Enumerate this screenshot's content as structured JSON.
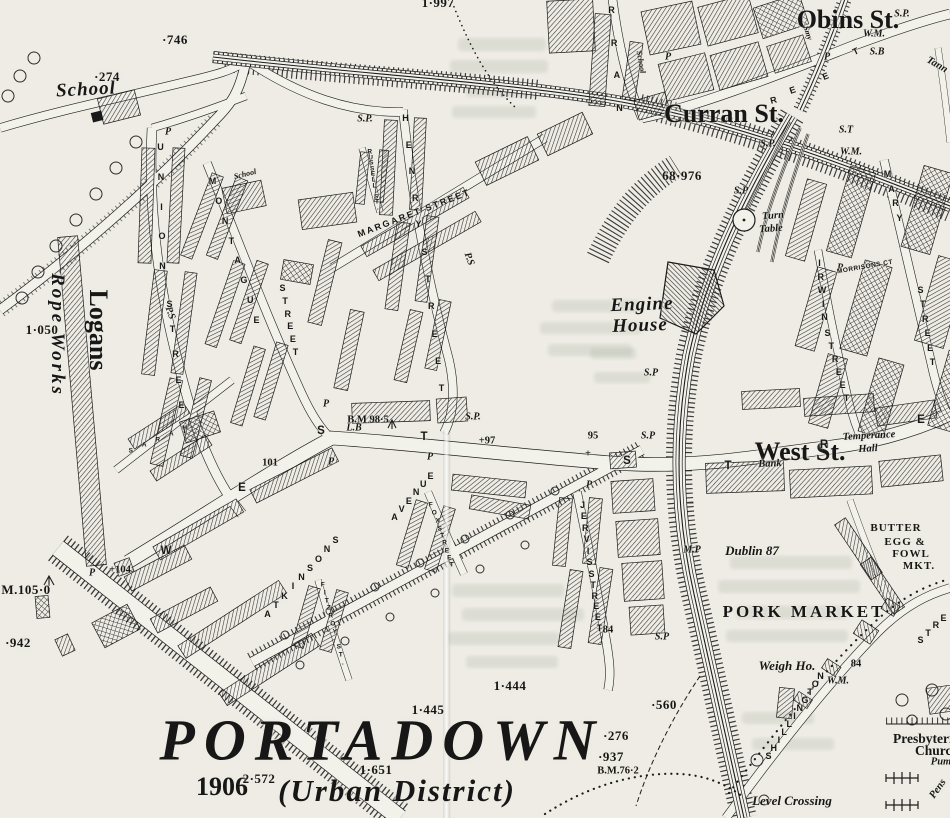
{
  "map": {
    "name": "Ordnance Survey town map, Portadown",
    "colors": {
      "paper": "#eeece4",
      "ink": "#171717",
      "annotation_red": "#cf2318"
    }
  },
  "labels": [
    {
      "t": "PORTADOWN",
      "x": 382,
      "y": 740,
      "c": "title",
      "n": "map-title"
    },
    {
      "t": "(Urban District)",
      "x": 397,
      "y": 791,
      "c": "subtitle",
      "n": "map-subtitle"
    },
    {
      "t": "1906",
      "x": 222,
      "y": 787,
      "c": "red",
      "n": "annotation-year"
    },
    {
      "t": "Obins St.",
      "x": 848,
      "y": 20,
      "c": "red",
      "n": "annotation-obins-st"
    },
    {
      "t": "Curran St.",
      "x": 724,
      "y": 114,
      "c": "red",
      "n": "annotation-curran-st"
    },
    {
      "t": "West St.",
      "x": 800,
      "y": 452,
      "c": "red",
      "n": "annotation-west-st"
    },
    {
      "t": "Logans",
      "x": 98,
      "y": 330,
      "r": 90,
      "c": "red",
      "n": "annotation-logans"
    },
    {
      "t": "School",
      "x": 86,
      "y": 90,
      "r": -3,
      "c": "pll",
      "n": "school-label"
    },
    {
      "t": "School",
      "x": 245,
      "y": 174,
      "r": -14,
      "c": "plxs"
    },
    {
      "t": "School",
      "x": 641,
      "y": 62,
      "r": 80,
      "c": "plxs"
    },
    {
      "t": "Rope Works",
      "x": 57,
      "y": 335,
      "r": 90,
      "c": "pll",
      "ls": 3,
      "n": "rope-works-label"
    },
    {
      "t": "Engine",
      "x": 642,
      "y": 305,
      "r": -2,
      "c": "pll",
      "n": "engine-house-label"
    },
    {
      "t": "House",
      "x": 640,
      "y": 326,
      "r": -2,
      "c": "pll"
    },
    {
      "t": "Turn",
      "x": 773,
      "y": 216,
      "r": -4,
      "c": "pls",
      "n": "turn-table-label"
    },
    {
      "t": "Table",
      "x": 771,
      "y": 229,
      "r": -4,
      "c": "pls"
    },
    {
      "t": "Temperance",
      "x": 869,
      "y": 436,
      "r": -3,
      "c": "pls",
      "n": "temperance-hall-label"
    },
    {
      "t": "Hall",
      "x": 868,
      "y": 449,
      "r": -3,
      "c": "pls"
    },
    {
      "t": "Bank",
      "x": 770,
      "y": 464,
      "r": -2,
      "c": "pls",
      "n": "bank-label"
    },
    {
      "t": "Dublin 87",
      "x": 752,
      "y": 551,
      "c": "pl",
      "n": "dublin-distance-label"
    },
    {
      "t": "Weigh Ho.",
      "x": 787,
      "y": 666,
      "c": "pl",
      "n": "weigh-house-label"
    },
    {
      "t": "Level Crossing",
      "x": 792,
      "y": 801,
      "c": "pl",
      "n": "level-crossing-label"
    },
    {
      "t": "PORK MARKET",
      "x": 804,
      "y": 612,
      "c": "capslg",
      "n": "pork-market-label"
    },
    {
      "t": "BUTTER",
      "x": 896,
      "y": 528,
      "c": "capsmd",
      "n": "butter-market-label"
    },
    {
      "t": "EGG &",
      "x": 905,
      "y": 542,
      "c": "capsmd"
    },
    {
      "t": "FOWL",
      "x": 911,
      "y": 554,
      "c": "capsmd"
    },
    {
      "t": "MKT.",
      "x": 919,
      "y": 566,
      "c": "capsmd"
    },
    {
      "t": "Presbyterian",
      "x": 930,
      "y": 739,
      "c": "church",
      "n": "presbyterian-church-label"
    },
    {
      "t": "Church",
      "x": 937,
      "y": 751,
      "c": "church"
    },
    {
      "t": "Pum",
      "x": 941,
      "y": 762,
      "c": "pls"
    },
    {
      "t": "Pens",
      "x": 938,
      "y": 789,
      "r": -55,
      "c": "pls"
    },
    {
      "t": "Tann",
      "x": 937,
      "y": 65,
      "r": 30,
      "c": "pls"
    },
    {
      "t": "Smy",
      "x": 808,
      "y": 33,
      "r": 72,
      "c": "plxs"
    },
    {
      "t": "·746",
      "x": 175,
      "y": 40,
      "c": "num"
    },
    {
      "t": "·274",
      "x": 107,
      "y": 77,
      "c": "num"
    },
    {
      "t": "1·050",
      "x": 42,
      "y": 330,
      "c": "num"
    },
    {
      "t": "68·976",
      "x": 682,
      "y": 176,
      "c": "num"
    },
    {
      "t": "1·997",
      "x": 438,
      "y": 3,
      "c": "num"
    },
    {
      "t": "M.105·0",
      "x": 26,
      "y": 590,
      "c": "num"
    },
    {
      "t": "·942",
      "x": 18,
      "y": 643,
      "c": "num"
    },
    {
      "t": "101",
      "x": 270,
      "y": 463,
      "c": "nums"
    },
    {
      "t": "1·444",
      "x": 510,
      "y": 686,
      "c": "num"
    },
    {
      "t": "1·445",
      "x": 428,
      "y": 710,
      "c": "num"
    },
    {
      "t": "·560",
      "x": 664,
      "y": 705,
      "c": "num"
    },
    {
      "t": "·276",
      "x": 616,
      "y": 736,
      "c": "num"
    },
    {
      "t": "·937",
      "x": 611,
      "y": 757,
      "c": "num"
    },
    {
      "t": "B.M.76·2",
      "x": 618,
      "y": 771,
      "c": "nums"
    },
    {
      "t": "2·572",
      "x": 259,
      "y": 779,
      "c": "num"
    },
    {
      "t": "1·651",
      "x": 376,
      "y": 770,
      "c": "num"
    },
    {
      "t": "84",
      "x": 856,
      "y": 664,
      "c": "nums"
    },
    {
      "t": "+104",
      "x": 120,
      "y": 570,
      "c": "nums"
    },
    {
      "t": "B.M 98·5",
      "x": 368,
      "y": 420,
      "c": "nums"
    },
    {
      "t": "+97",
      "x": 487,
      "y": 441,
      "c": "nums"
    },
    {
      "t": "95",
      "x": 593,
      "y": 436,
      "c": "nums"
    },
    {
      "t": "+",
      "x": 588,
      "y": 454,
      "c": "nums"
    },
    {
      "t": "+84",
      "x": 605,
      "y": 630,
      "c": "nums"
    },
    {
      "t": "S.P.",
      "x": 365,
      "y": 119,
      "c": "mk"
    },
    {
      "t": "S.P.",
      "x": 768,
      "y": 144,
      "c": "mk"
    },
    {
      "t": "S.P",
      "x": 741,
      "y": 191,
      "c": "mk"
    },
    {
      "t": "S.P.",
      "x": 902,
      "y": 14,
      "c": "mk"
    },
    {
      "t": "S.P",
      "x": 651,
      "y": 373,
      "c": "mk"
    },
    {
      "t": "S.P",
      "x": 648,
      "y": 436,
      "c": "mk"
    },
    {
      "t": "S.P.",
      "x": 473,
      "y": 417,
      "c": "mk"
    },
    {
      "t": "S.P",
      "x": 662,
      "y": 637,
      "c": "mk"
    },
    {
      "t": "S.B",
      "x": 877,
      "y": 52,
      "c": "mk"
    },
    {
      "t": "W.M.",
      "x": 874,
      "y": 34,
      "c": "mk"
    },
    {
      "t": "W.M.",
      "x": 851,
      "y": 152,
      "c": "mk"
    },
    {
      "t": "W.M.",
      "x": 838,
      "y": 681,
      "c": "mk"
    },
    {
      "t": "S.T",
      "x": 846,
      "y": 130,
      "c": "mk"
    },
    {
      "t": "M.P",
      "x": 692,
      "y": 550,
      "c": "mk"
    },
    {
      "t": "L.B",
      "x": 354,
      "y": 428,
      "c": "mk"
    },
    {
      "t": "P",
      "x": 168,
      "y": 132,
      "c": "mk"
    },
    {
      "t": "P",
      "x": 326,
      "y": 404,
      "c": "mk"
    },
    {
      "t": "P",
      "x": 331,
      "y": 462,
      "c": "mk"
    },
    {
      "t": "P",
      "x": 92,
      "y": 573,
      "c": "mk"
    },
    {
      "t": "P",
      "x": 589,
      "y": 485,
      "c": "mk"
    },
    {
      "t": "P",
      "x": 840,
      "y": 268,
      "c": "mk"
    },
    {
      "t": "P",
      "x": 668,
      "y": 57,
      "c": "mk"
    },
    {
      "t": "P",
      "x": 430,
      "y": 457,
      "c": "mk"
    },
    {
      "t": "P",
      "x": 827,
      "y": 57,
      "c": "mk"
    },
    {
      "t": "P.S",
      "x": 170,
      "y": 313,
      "r": 70,
      "c": "mk"
    },
    {
      "t": "P.S",
      "x": 469,
      "y": 259,
      "r": 70,
      "c": "mk"
    },
    {
      "t": "UNION",
      "x1": 161,
      "y1": 147,
      "x2": 163,
      "y2": 266,
      "c": "st",
      "n": "union-street-label"
    },
    {
      "t": "STREET",
      "x1": 170,
      "y1": 304,
      "x2": 185,
      "y2": 430,
      "c": "st"
    },
    {
      "t": "MONTAGUE",
      "x1": 213,
      "y1": 181,
      "x2": 257,
      "y2": 320,
      "c": "st",
      "n": "montague-street-label"
    },
    {
      "t": "STREET",
      "x1": 283,
      "y1": 288,
      "x2": 296,
      "y2": 352,
      "c": "st"
    },
    {
      "t": "HENRY",
      "x1": 406,
      "y1": 118,
      "x2": 419,
      "y2": 224,
      "c": "st",
      "n": "henry-street-label"
    },
    {
      "t": "STREET",
      "x1": 425,
      "y1": 252,
      "x2": 442,
      "y2": 388,
      "c": "st"
    },
    {
      "t": "RUSSELL ST.",
      "x1": 370,
      "y1": 152,
      "x2": 378,
      "y2": 208,
      "c": "stxs",
      "n": "russell-street-label"
    },
    {
      "t": "RRAN",
      "x1": 612,
      "y1": 10,
      "x2": 620,
      "y2": 108,
      "c": "st",
      "n": "curran-street-letters"
    },
    {
      "t": "MARY",
      "x1": 888,
      "y1": 174,
      "x2": 900,
      "y2": 218,
      "c": "st",
      "n": "mary-street-label"
    },
    {
      "t": "STREET",
      "x1": 921,
      "y1": 290,
      "x2": 933,
      "y2": 362,
      "c": "st"
    },
    {
      "t": "IRWIN",
      "x1": 820,
      "y1": 263,
      "x2": 825,
      "y2": 317,
      "c": "st",
      "n": "irwin-street-label"
    },
    {
      "t": "STREET",
      "x1": 828,
      "y1": 333,
      "x2": 847,
      "y2": 398,
      "c": "st"
    },
    {
      "t": "JERVIS",
      "x1": 583,
      "y1": 505,
      "x2": 590,
      "y2": 562,
      "c": "st",
      "n": "jervis-street-label"
    },
    {
      "t": "STREET",
      "x1": 592,
      "y1": 574,
      "x2": 600,
      "y2": 628,
      "c": "st"
    },
    {
      "t": "FOX",
      "x1": 431,
      "y1": 505,
      "x2": 438,
      "y2": 521,
      "c": "stxs",
      "n": "fox-street-label"
    },
    {
      "t": "STREET",
      "x1": 440,
      "y1": 529,
      "x2": 452,
      "y2": 565,
      "c": "stxs"
    },
    {
      "t": "FITZROY ST.",
      "x1": 323,
      "y1": 585,
      "x2": 343,
      "y2": 663,
      "c": "stxs",
      "n": "fitzroy-street-label"
    },
    {
      "t": "ATKINSONS",
      "x1": 268,
      "y1": 614,
      "x2": 336,
      "y2": 540,
      "c": "st",
      "n": "atkinsons-avenue-label"
    },
    {
      "t": "AVENUE",
      "x1": 395,
      "y1": 517,
      "x2": 431,
      "y2": 476,
      "c": "st"
    },
    {
      "t": "SHILLINGTON",
      "x1": 769,
      "y1": 756,
      "x2": 821,
      "y2": 676,
      "c": "st",
      "n": "shillington-street-label"
    },
    {
      "t": "STRE",
      "x1": 921,
      "y1": 640,
      "x2": 944,
      "y2": 618,
      "c": "st"
    },
    {
      "t": "SARAH",
      "x1": 131,
      "y1": 451,
      "x2": 185,
      "y2": 428,
      "c": "stxs",
      "n": "sarah-street-label"
    },
    {
      "t": "MARGARET STREET",
      "x": 414,
      "y": 213,
      "r": -21,
      "c": "st",
      "ls": 2,
      "n": "margaret-street-label"
    },
    {
      "t": "MORRISONS CT",
      "x": 865,
      "y": 267,
      "r": -10,
      "c": "stxs",
      "n": "morrisons-court-label"
    },
    {
      "t": "W",
      "x": 166,
      "y": 551,
      "c": "stlg",
      "n": "west-street-letter"
    },
    {
      "t": "E",
      "x": 242,
      "y": 488,
      "c": "stlg",
      "n": "west-street-letter"
    },
    {
      "t": "S",
      "x": 321,
      "y": 431,
      "c": "stlg",
      "n": "west-street-letter"
    },
    {
      "t": "T",
      "x": 424,
      "y": 437,
      "c": "stlg",
      "n": "west-street-letter"
    },
    {
      "t": "S",
      "x": 627,
      "y": 461,
      "c": "stlg",
      "n": "west-street-letter"
    },
    {
      "t": "T",
      "x": 728,
      "y": 466,
      "c": "stlg",
      "n": "west-street-letter"
    },
    {
      "t": "R",
      "x": 824,
      "y": 445,
      "c": "stlg",
      "n": "west-street-letter"
    },
    {
      "t": "E",
      "x": 921,
      "y": 420,
      "c": "stlg",
      "n": "west-street-letter"
    },
    {
      "t": "R",
      "x": 774,
      "y": 100,
      "r": -15,
      "c": "st",
      "n": "obins-street-letter"
    },
    {
      "t": "E",
      "x": 793,
      "y": 90,
      "r": -18,
      "c": "st",
      "n": "obins-street-letter"
    },
    {
      "t": "E",
      "x": 826,
      "y": 76,
      "r": -22,
      "c": "st",
      "n": "obins-street-letter"
    },
    {
      "t": "T",
      "x": 856,
      "y": 51,
      "r": -25,
      "c": "st",
      "n": "obins-street-letter"
    }
  ]
}
